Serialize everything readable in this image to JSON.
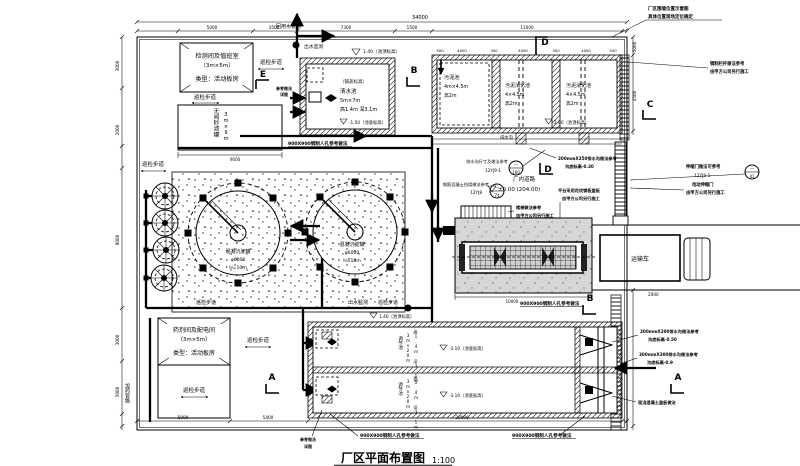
{
  "title": {
    "name": "厂区平面布置图",
    "scale": "1:100"
  },
  "buildings": {
    "monitor": {
      "l1": "检测间及值班室",
      "l2": "（3m×5m）",
      "l3": "类型：活动板房"
    },
    "chemical": {
      "l1": "药剂间及配电间",
      "l2": "（3m×5m）",
      "l3": "类型：活动板房"
    }
  },
  "tanks": {
    "sand_filter": {
      "name": "无阀砂滤罐",
      "size": "3m×9m"
    },
    "clear_pool": {
      "top": "1.40（池顶标高）",
      "cover": "（铺盖标高）",
      "name": "清水池",
      "size": "5m×7m",
      "dims": "高1.4m 深3.1m",
      "bottom": "-1.50（池底标高）"
    },
    "sludge_pool": {
      "name": "污泥池",
      "size": "4m×4.5m",
      "height": "高2m"
    },
    "digest_pool": {
      "name": "污泥消化池",
      "size": "4×4.5m",
      "height": "高2m"
    },
    "pool_top_elev": "2.00（池顶标高）",
    "coag_tank": {
      "name": "混凝沉淀罐",
      "dia": "φ6000",
      "height": "H=10m"
    },
    "regulating": {
      "name": "调节池",
      "size": "3m×20m",
      "dims": "高1.4m 深3.1m",
      "top": "1.40（池顶标高）",
      "bottom": "-3.10（池底标高）"
    }
  },
  "labels": {
    "walkway": "巡检步道",
    "reuse_pipe": "回用水管路",
    "outlet_monitor": "出水监测",
    "dosing_pipe": "加药管路",
    "drain_ditch": "排水沟",
    "road": "厂内道路",
    "road_elev": "±0.00 (204.00)",
    "truck": "运输车"
  },
  "notes": {
    "fence1": "厂区围墙位置示意图",
    "fence2": "具体位置现场定位确定",
    "railing1": "钢制栏杆做法参考",
    "railing2": "由甲方公司另行施工",
    "gate_ref1": "伸缩门做法可参考",
    "gate_ref2": "12YJ9-1",
    "gate1": "电动伸缩门",
    "gate2": "由甲方公司另行施工",
    "cover1": "平台采用花纹钢板盖板",
    "cover2": "由甲方公司另行施工",
    "stair1": "楼梯做法参考",
    "stair2": "由甲方公司另行施工",
    "ditch_ref1": "排水沟尺寸及做法参考",
    "ditch_ref2": "12YJ9-1",
    "wall_ref1": "钢筋混凝土挡墙做法参考",
    "wall_ref2": "12YJ8",
    "ditch250a": "200mmX250排水沟做法参考",
    "ditch250b": "沟底标高-0.30",
    "ditch200a": "200mmX200排水沟做法参考",
    "ditch200b": "沟底标高-0.50",
    "ditch300a": "300mmX300排水沟做法参考",
    "ditch300b": "沟底标高-0.9",
    "cast_cover": "现浇混凝土盖板做法",
    "manhole": "900X900钢制人孔参考做法",
    "detail1": "参考做法",
    "detail2": "详图"
  },
  "callouts": {
    "dash": "—",
    "n100": "100",
    "n74": "74",
    "n41": "41"
  },
  "sections": {
    "A": "A",
    "B": "B",
    "C": "C",
    "D": "D",
    "E": "E"
  },
  "dims": {
    "top_total": "34000",
    "top": [
      "5000",
      "3500",
      "7300",
      "1500",
      "11000"
    ],
    "left": [
      "3000",
      "2000",
      "9000",
      "3000",
      "5000"
    ],
    "bottom": [
      "5000",
      "5400",
      "20000"
    ],
    "right": [
      "5000",
      "4500",
      "2000"
    ],
    "pool_top": [
      "500",
      "4000",
      "300",
      "4000",
      "300",
      "4000",
      "500"
    ],
    "sand_w": "9000",
    "platform_w": "10000"
  }
}
